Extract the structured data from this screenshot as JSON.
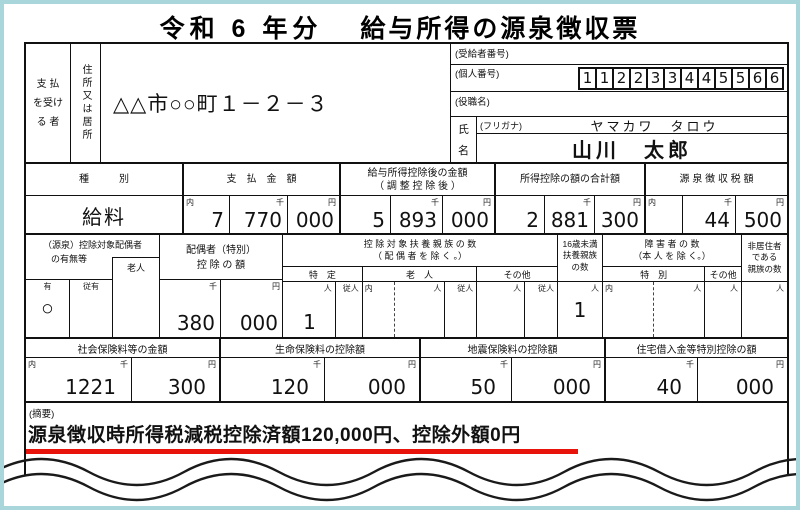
{
  "page": {
    "frame_color": "#a9d6da",
    "line_color": "#111111",
    "red_color": "#e8140c"
  },
  "title": {
    "era": "令和 6 年分",
    "name": "給与所得の源泉徴収票"
  },
  "identity": {
    "payer_label_lines": [
      "支 払",
      "を受け",
      "る 者"
    ],
    "address_label": "住所又は居所",
    "address": "△△市○○町１－２－３",
    "recipient_number_label": "(受給者番号)",
    "personal_number_label": "(個人番号)",
    "personal_number": [
      "1",
      "1",
      "2",
      "2",
      "3",
      "3",
      "4",
      "4",
      "5",
      "5",
      "6",
      "6"
    ],
    "position_label": "(役職名)",
    "name_label_chars": [
      "氏",
      "名"
    ],
    "furigana_label": "(フリガナ)",
    "furigana_value": "ヤマカワ　タロウ",
    "name_value": "山川　太郎"
  },
  "markers": {
    "uchi": "内",
    "sen": "千",
    "en": "円",
    "nin": "人",
    "junin": "従人"
  },
  "income": {
    "type_header": "種　　　別",
    "type_value": "給料",
    "payment_header": "支　払　金　額",
    "payment": [
      "7",
      "770",
      "000"
    ],
    "after_deduction_header1": "給与所得控除後の金額",
    "after_deduction_header2": "（ 調 整 控 除 後 ）",
    "after_deduction": [
      "5",
      "893",
      "000"
    ],
    "total_deduction_header": "所得控除の額の合計額",
    "total_deduction": [
      "2",
      "881",
      "300"
    ],
    "withholding_header": "源 泉 徴 収 税 額",
    "withholding": [
      "",
      "44",
      "500"
    ]
  },
  "spouse": {
    "header_line1": "（源泉）控除対象配偶者",
    "header_line2": "の有無等",
    "elderly_label": "老人",
    "yes_label": "有",
    "sub_yes_label": "従有",
    "yes_value": "○",
    "deduction_header1": "配偶者（特別）",
    "deduction_header2": "控 除 の 額",
    "deduction": [
      "380",
      "000"
    ]
  },
  "dependents": {
    "header_line1": "控 除 対 象 扶 養 親 族 の 数",
    "header_line2": "（ 配 偶 者 を 除 く 。）",
    "specific_label": "特　定",
    "specific_value": "1",
    "elderly_label": "老　人",
    "other_label": "その他",
    "under16_label_lines": [
      "16歳未満",
      "扶養親族",
      "の数"
    ],
    "under16_value": "1",
    "disability_header1": "障 害 者 の 数",
    "disability_header2": "（本 人 を 除 く。）",
    "disability_special_label": "特　別",
    "disability_other_label": "その他",
    "nonresident_label_lines": [
      "非居住者",
      "である",
      "親族の数"
    ]
  },
  "insurance": {
    "social_header": "社会保険料等の金額",
    "social": [
      "1221",
      "300"
    ],
    "life_header": "生命保険料の控除額",
    "life": [
      "120",
      "000"
    ],
    "earthquake_header": "地震保険料の控除額",
    "earthquake": [
      "50",
      "000"
    ],
    "housing_header": "住宅借入金等特別控除の額",
    "housing": [
      "40",
      "000"
    ]
  },
  "summary": {
    "label": "(摘要)",
    "note": "源泉徴収時所得税減税控除済額120,000円、控除外額0円"
  }
}
